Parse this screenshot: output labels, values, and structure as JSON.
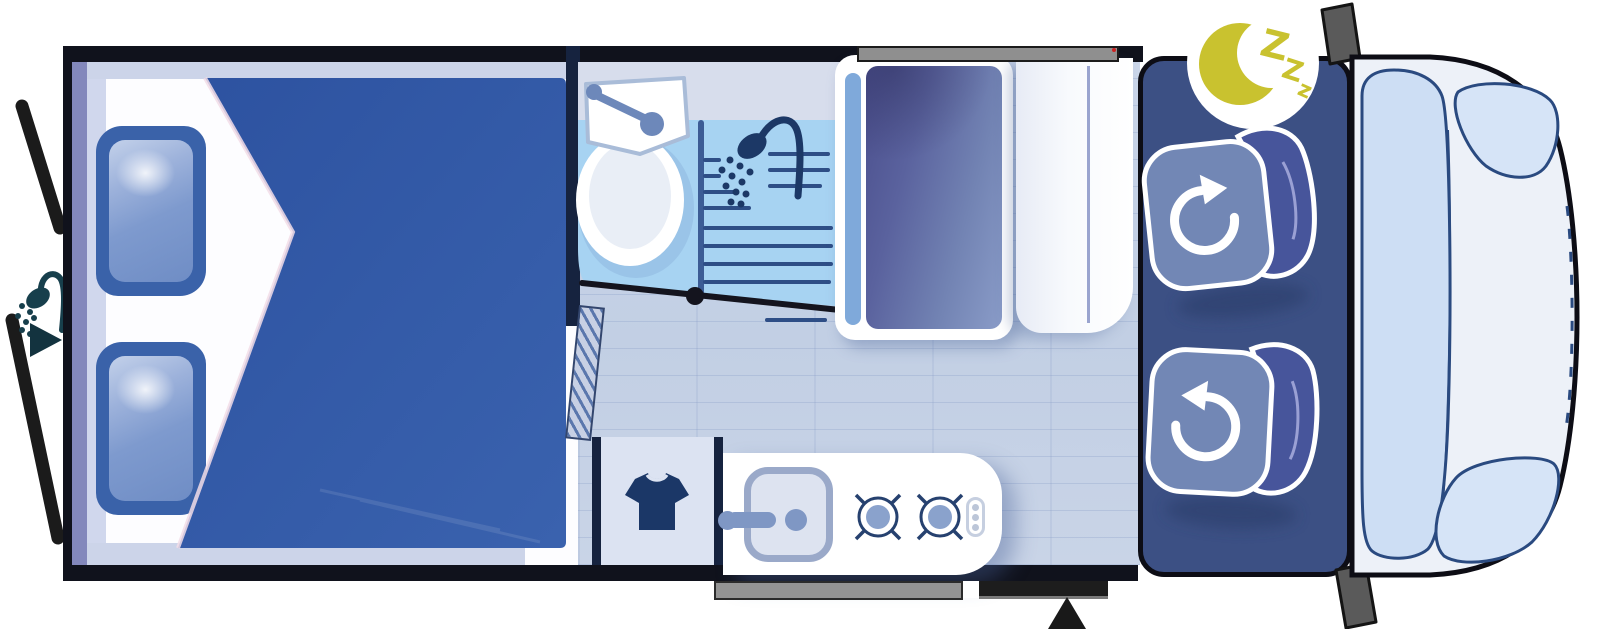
{
  "meta": {
    "title": "Motorhome floor plan - night layout"
  },
  "badge": {
    "letters": {
      "l1": "Z",
      "l2": "Z",
      "l3": "z"
    }
  },
  "icons": [
    "moon-icon",
    "sleep-zzz-label",
    "rotate-clockwise-icon",
    "rotate-counterclockwise-icon",
    "shower-head-icon",
    "outdoor-shower-icon",
    "direction-arrow-icon",
    "tshirt-icon",
    "burner-icon",
    "faucet-icon"
  ],
  "colors": {
    "duvet": "#33599f",
    "pillow": "#3a62a9",
    "cab": "#3c5084",
    "seat_cushion": "#7287b5",
    "seat_back": "#47559b",
    "bathroom_floor": "#a7d3f2",
    "corridor_floor": "#c6d2e5",
    "counter": "#d7ddec",
    "wardrobe": "#dce3f2",
    "cubicle_panel": "#5a629e",
    "van_body": "#edf1f8",
    "windshield": "#cddef4",
    "moon": "#c9c22f",
    "outline": "#10121c"
  }
}
